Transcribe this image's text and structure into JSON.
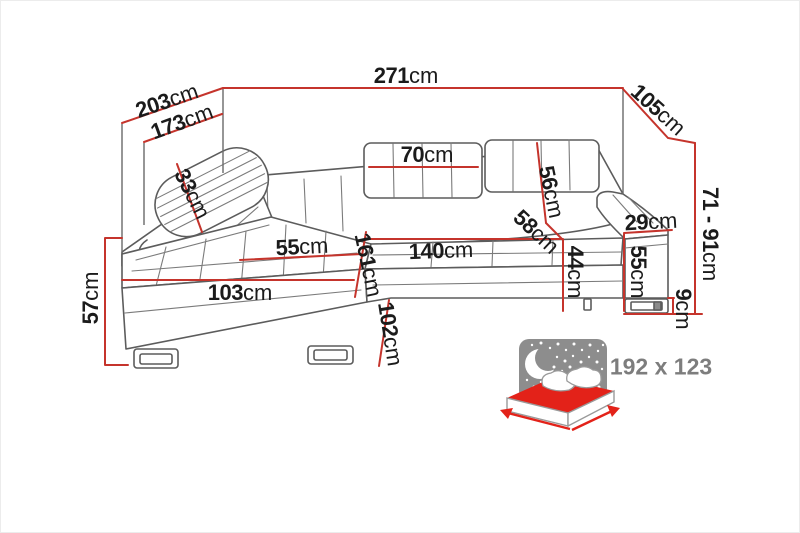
{
  "diagram": {
    "type": "corner-sofa-dimension-drawing",
    "unit": "cm",
    "colors": {
      "dimension_line_red": "#c5342c",
      "drawing_line_gray": "#5c5c5c",
      "label_text": "#1b1b1b",
      "night_icon_gray": "#8d8d8d",
      "sleeping_text_gray": "#7d7d7d",
      "mattress_red": "#e32219",
      "background": "#ffffff"
    },
    "icons": [
      "moon-icon",
      "stars-icon",
      "sleeping-bed-icon"
    ]
  },
  "dims": {
    "total_width": {
      "value": "271",
      "unit": "cm"
    },
    "depth_left_total": {
      "value": "203",
      "unit": "cm"
    },
    "depth_left_inner": {
      "value": "173",
      "unit": "cm"
    },
    "depth_right": {
      "value": "105",
      "unit": "cm"
    },
    "height_range": {
      "value": "71 - 91",
      "unit": "cm"
    },
    "headrest_width": {
      "value": "70",
      "unit": "cm"
    },
    "backrest_height": {
      "value": "56",
      "unit": "cm"
    },
    "seat_depth": {
      "value": "58",
      "unit": "cm"
    },
    "headrest_pillow": {
      "value": "33",
      "unit": "cm"
    },
    "armrest_width": {
      "value": "29",
      "unit": "cm"
    },
    "armrest_height": {
      "value": "55",
      "unit": "cm"
    },
    "seat_height": {
      "value": "44",
      "unit": "cm"
    },
    "leg_height": {
      "value": "9",
      "unit": "cm"
    },
    "seat_width_right": {
      "value": "140",
      "unit": "cm"
    },
    "chaise_seat_width": {
      "value": "55",
      "unit": "cm"
    },
    "chaise_front_width": {
      "value": "103",
      "unit": "cm"
    },
    "chaise_length": {
      "value": "161",
      "unit": "cm"
    },
    "chaise_depth": {
      "value": "102",
      "unit": "cm"
    },
    "chaise_height": {
      "value": "57",
      "unit": "cm"
    }
  },
  "sleeping": {
    "label": "192 x 123"
  }
}
